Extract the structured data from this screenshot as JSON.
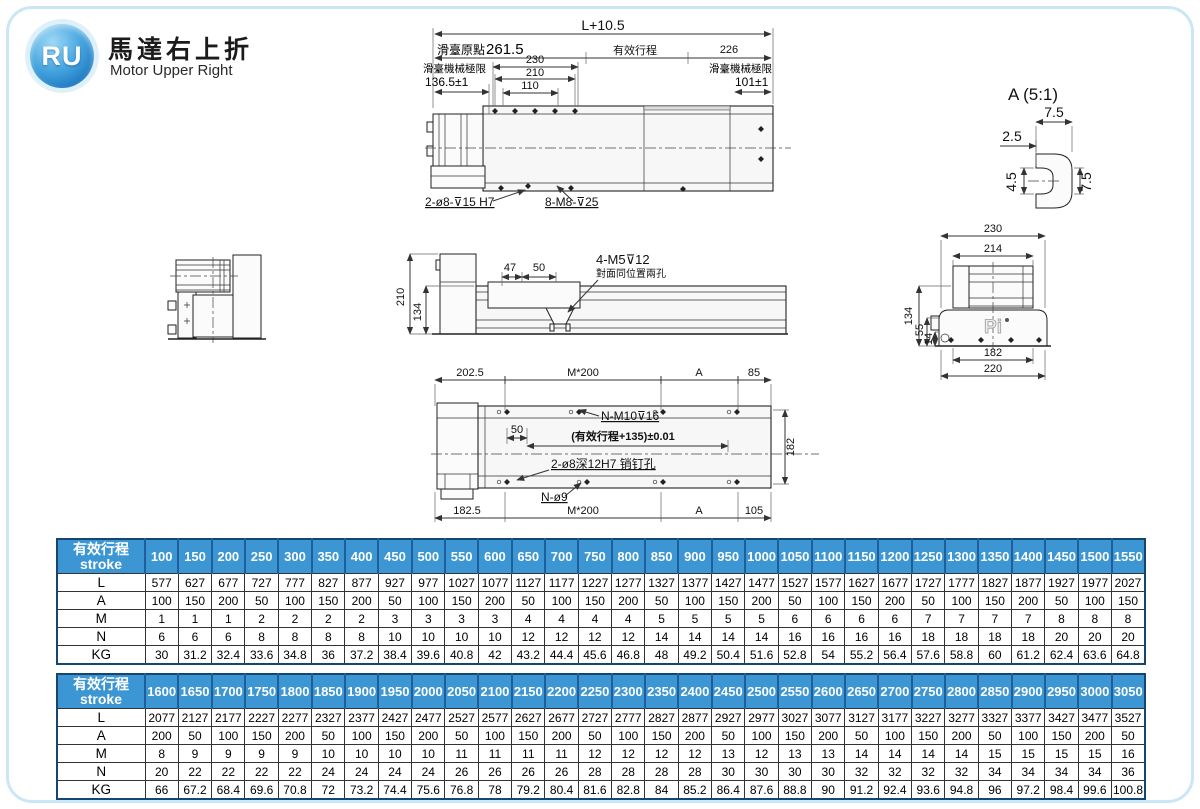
{
  "header": {
    "logo": "RU",
    "title_zh": "馬達右上折",
    "title_en": "Motor Upper Right"
  },
  "colors": {
    "table_header_bg": "#3b96d3",
    "table_header_divider": "#1f5e99",
    "table_border": "#16456f",
    "logo_blue": "#1673c8",
    "page_border": "#c9e7f5"
  },
  "drawings": {
    "top_view": {
      "dim_overall": "L+10.5",
      "dim_origin_zh": "滑臺原點",
      "dim_origin_val": "261.5",
      "dim_stroke_zh": "有效行程",
      "dim_right": "226",
      "dim_230": "230",
      "dim_210": "210",
      "dim_110": "110",
      "limit_left_zh": "滑臺機械極限",
      "limit_left_val": "136.5±1",
      "limit_right_zh": "滑臺機械極限",
      "limit_right_val": "101±1",
      "callout_pin": "2-ø8-⊽15 H7",
      "callout_tap": "8-M8-⊽25"
    },
    "detail_a": {
      "title": "A (5:1)",
      "width_top": "7.5",
      "offset_left": "2.5",
      "slot_height": "4.5",
      "depth_right": "7.5"
    },
    "elevation": {
      "height_total": "210",
      "height_body": "134",
      "dim_47": "47",
      "dim_50": "50",
      "callout_taps": "4-M5⊽12",
      "callout_note": "對面同位置兩孔"
    },
    "cross_section": {
      "width_top": "230",
      "width_inner": "214",
      "height_left": "134",
      "height_mid": "55",
      "height_low": "14",
      "width_bottom_inner": "182",
      "width_bottom": "220",
      "brand": "Pi"
    },
    "bottom_view": {
      "top_dims": [
        "202.5",
        "M*200",
        "A",
        "85"
      ],
      "callout_taps": "N-M10⊽16",
      "dim_50": "50",
      "dim_stroke": "(有效行程+135)±0.01",
      "callout_pins": "2-ø8深12H7 销钉孔",
      "callout_holes": "N-ø9",
      "height_right": "182",
      "bottom_dims": [
        "182.5",
        "M*200",
        "A",
        "105"
      ]
    }
  },
  "tables": [
    {
      "title_zh": "有效行程",
      "title_en": "stroke",
      "strokes": [
        "100",
        "150",
        "200",
        "250",
        "300",
        "350",
        "400",
        "450",
        "500",
        "550",
        "600",
        "650",
        "700",
        "750",
        "800",
        "850",
        "900",
        "950",
        "1000",
        "1050",
        "1100",
        "1150",
        "1200",
        "1250",
        "1300",
        "1350",
        "1400",
        "1450",
        "1500",
        "1550"
      ],
      "rows": [
        {
          "label": "L",
          "values": [
            577,
            627,
            677,
            727,
            777,
            827,
            877,
            927,
            977,
            1027,
            1077,
            1127,
            1177,
            1227,
            1277,
            1327,
            1377,
            1427,
            1477,
            1527,
            1577,
            1627,
            1677,
            1727,
            1777,
            1827,
            1877,
            1927,
            1977,
            2027
          ]
        },
        {
          "label": "A",
          "values": [
            100,
            150,
            200,
            50,
            100,
            150,
            200,
            50,
            100,
            150,
            200,
            50,
            100,
            150,
            200,
            50,
            100,
            150,
            200,
            50,
            100,
            150,
            200,
            50,
            100,
            150,
            200,
            50,
            100,
            150
          ]
        },
        {
          "label": "M",
          "values": [
            1,
            1,
            1,
            2,
            2,
            2,
            2,
            3,
            3,
            3,
            3,
            4,
            4,
            4,
            4,
            5,
            5,
            5,
            5,
            6,
            6,
            6,
            6,
            7,
            7,
            7,
            7,
            8,
            8,
            8
          ]
        },
        {
          "label": "N",
          "values": [
            6,
            6,
            6,
            8,
            8,
            8,
            8,
            10,
            10,
            10,
            10,
            12,
            12,
            12,
            12,
            14,
            14,
            14,
            14,
            16,
            16,
            16,
            16,
            18,
            18,
            18,
            18,
            20,
            20,
            20
          ]
        },
        {
          "label": "KG",
          "values": [
            30,
            31.2,
            32.4,
            33.6,
            34.8,
            36,
            37.2,
            38.4,
            39.6,
            40.8,
            42,
            43.2,
            44.4,
            45.6,
            46.8,
            48,
            49.2,
            50.4,
            51.6,
            52.8,
            54,
            55.2,
            56.4,
            57.6,
            58.8,
            60,
            61.2,
            62.4,
            63.6,
            64.8
          ]
        }
      ]
    },
    {
      "title_zh": "有效行程",
      "title_en": "stroke",
      "strokes": [
        "1600",
        "1650",
        "1700",
        "1750",
        "1800",
        "1850",
        "1900",
        "1950",
        "2000",
        "2050",
        "2100",
        "2150",
        "2200",
        "2250",
        "2300",
        "2350",
        "2400",
        "2450",
        "2500",
        "2550",
        "2600",
        "2650",
        "2700",
        "2750",
        "2800",
        "2850",
        "2900",
        "2950",
        "3000",
        "3050"
      ],
      "rows": [
        {
          "label": "L",
          "values": [
            2077,
            2127,
            2177,
            2227,
            2277,
            2327,
            2377,
            2427,
            2477,
            2527,
            2577,
            2627,
            2677,
            2727,
            2777,
            2827,
            2877,
            2927,
            2977,
            3027,
            3077,
            3127,
            3177,
            3227,
            3277,
            3327,
            3377,
            3427,
            3477,
            3527
          ]
        },
        {
          "label": "A",
          "values": [
            200,
            50,
            100,
            150,
            200,
            50,
            100,
            150,
            200,
            50,
            100,
            150,
            200,
            50,
            100,
            150,
            200,
            50,
            100,
            150,
            200,
            50,
            100,
            150,
            200,
            50,
            100,
            150,
            200,
            50
          ]
        },
        {
          "label": "M",
          "values": [
            8,
            9,
            9,
            9,
            9,
            10,
            10,
            10,
            10,
            11,
            11,
            11,
            11,
            12,
            12,
            12,
            12,
            13,
            12,
            13,
            13,
            14,
            14,
            14,
            14,
            15,
            15,
            15,
            15,
            16
          ]
        },
        {
          "label": "N",
          "values": [
            20,
            22,
            22,
            22,
            22,
            24,
            24,
            24,
            24,
            26,
            26,
            26,
            26,
            28,
            28,
            28,
            28,
            30,
            30,
            30,
            30,
            32,
            32,
            32,
            32,
            34,
            34,
            34,
            34,
            36
          ]
        },
        {
          "label": "KG",
          "values": [
            66,
            67.2,
            68.4,
            69.6,
            70.8,
            72,
            73.2,
            74.4,
            75.6,
            76.8,
            78,
            79.2,
            80.4,
            81.6,
            82.8,
            84,
            85.2,
            86.4,
            87.6,
            88.8,
            90,
            91.2,
            92.4,
            93.6,
            94.8,
            96,
            97.2,
            98.4,
            99.6,
            100.8
          ]
        }
      ]
    }
  ]
}
